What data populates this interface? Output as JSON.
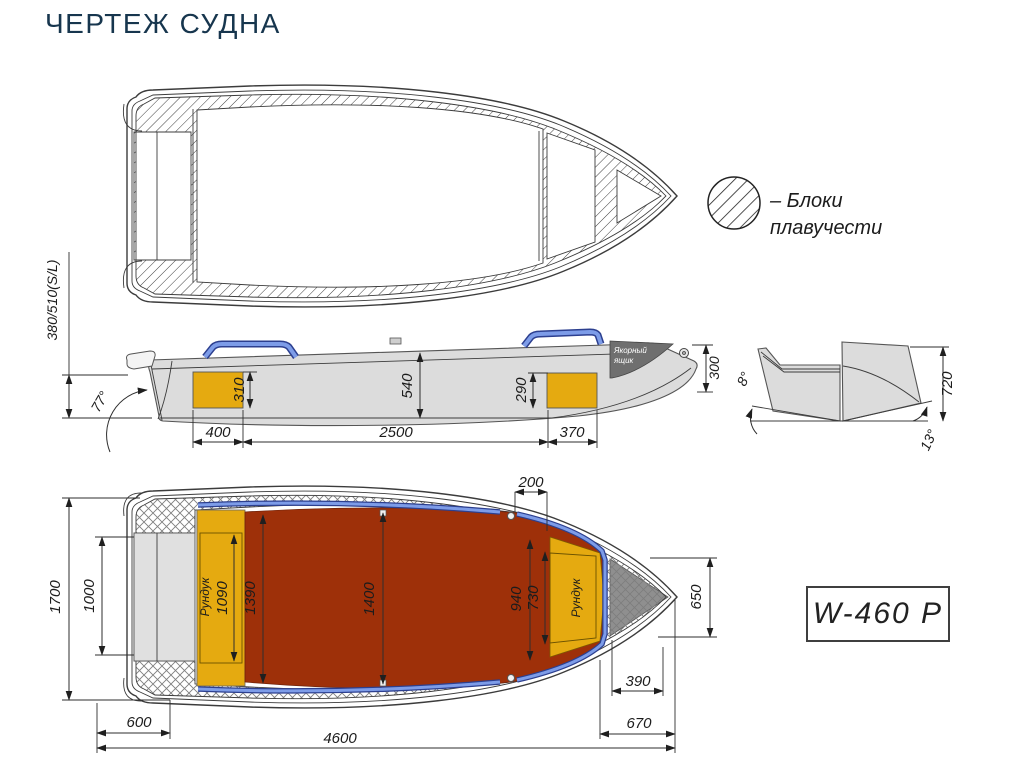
{
  "title": "ЧЕРТЕЖ СУДНА",
  "model_label": "W-460 P",
  "legend": {
    "line1": "– Блоки",
    "line2": "плавучести"
  },
  "colors": {
    "title_navy": "#17364e",
    "hull_gray": "#dcdcdc",
    "deck_red": "#9e3009",
    "locker_yellow": "#e5aa10",
    "rail_blue_light": "#7d9ce8",
    "rail_blue_dark": "#2c3f8f",
    "anchor_dark": "#6f6f6f",
    "anchor_dark_plan": "#8f8f8f"
  },
  "side_view": {
    "transom_height": "380/510(S/L)",
    "transom_angle": "77°",
    "stern_locker_height": "310",
    "depth_midship": "540",
    "bow_locker_height": "290",
    "bow_height": "300",
    "stern_locker_length": "400",
    "cockpit_length": "2500",
    "bow_locker_length": "370",
    "anchor_box_line1": "Якорный",
    "anchor_box_line2": "ящик"
  },
  "transom_view": {
    "flare_angle": "8°",
    "height": "720",
    "deadrise_angle": "13°"
  },
  "plan_view": {
    "beam_overall": "1700",
    "transom_inner_width": "1000",
    "stern_locker_label": "Рундук",
    "stern_locker_width": "1090",
    "stern_cockpit_width": "1390",
    "cockpit_width": "1400",
    "bow_cockpit_width": "940",
    "bow_locker_width": "730",
    "bow_step": "200",
    "bow_section_height": "650",
    "anchor_locker_width": "390",
    "bow_overhang": "670",
    "stern_overhang": "600",
    "length_overall": "4600",
    "bow_locker_label": "Рундук"
  }
}
